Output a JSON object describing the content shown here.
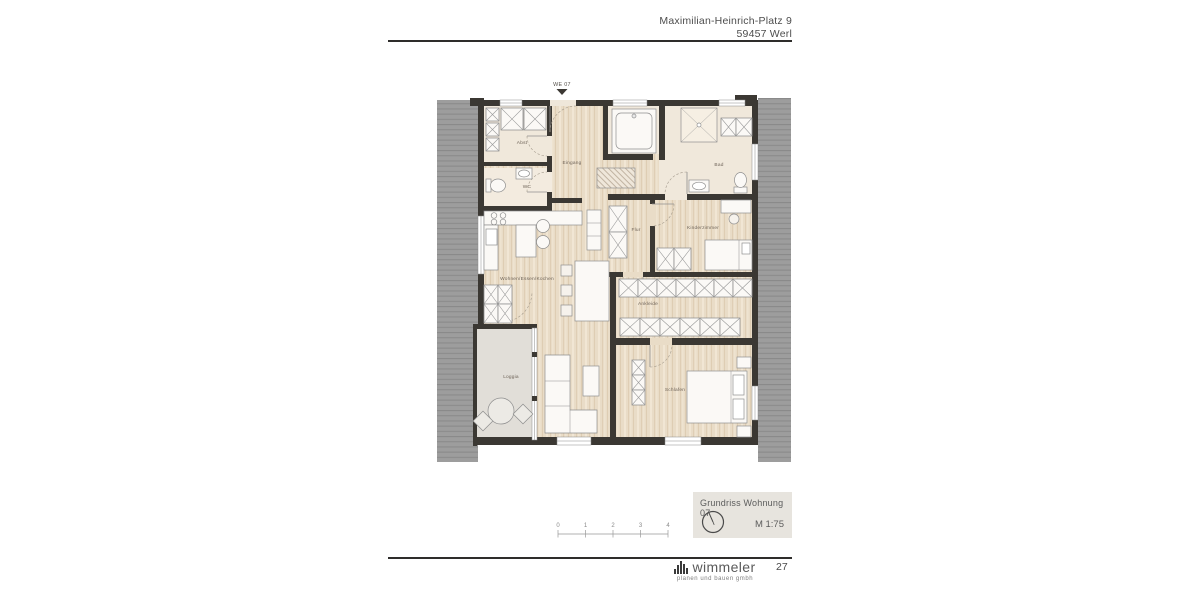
{
  "page": {
    "number": "27"
  },
  "header": {
    "address_line1": "Maximilian-Heinrich-Platz 9",
    "address_line2": "59457 Werl"
  },
  "plan": {
    "unit_label": "WE 07",
    "room_labels": {
      "abst": "Abst",
      "wc": "WC",
      "eingang": "Eingang",
      "bad": "Bad",
      "flur": "Flur",
      "kinderzimmer": "Kinderzimmer",
      "wohnen": "Wohnen/Essen/Kochen",
      "ankleide": "Ankleide",
      "loggia": "Loggia",
      "schlafen": "Schlafen"
    }
  },
  "title_block": {
    "title": "Grundriss Wohnung 07",
    "scale": "M 1:75",
    "north_icon": "north-arrow-compass"
  },
  "scale_bar": {
    "unit_labels": [
      "0",
      "1",
      "2",
      "3",
      "4"
    ]
  },
  "footer": {
    "logo_text": "wimmeler",
    "logo_subtext": "planen und bauen gmbh",
    "logo_icon": "wimmeler-bars-logo"
  },
  "colors": {
    "wall": "#3b3833",
    "roof_gray": "#9d9d9d",
    "wood_floor": "#e9dcc7",
    "tile_floor": "#f0e8db",
    "loggia_floor": "#e1ded8",
    "title_block_bg": "#e7e4de"
  }
}
